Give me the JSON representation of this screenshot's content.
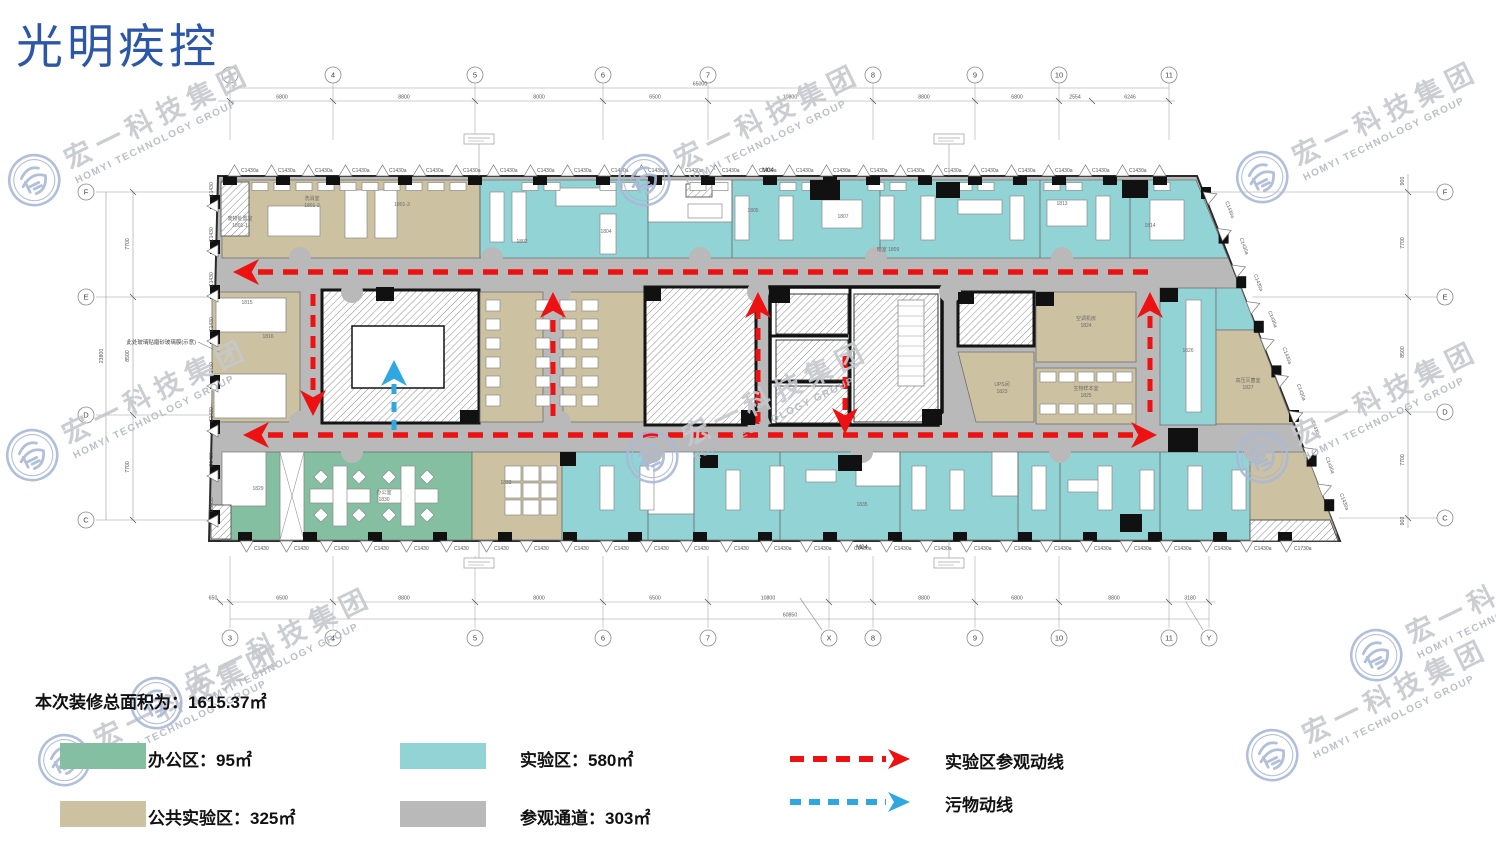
{
  "title": "光明疾控",
  "watermark": {
    "cn": "宏一科技集团",
    "en": "HOMYI TECHNOLOGY GROUP"
  },
  "summary": {
    "label": "本次装修总面积为：1615.37㎡"
  },
  "legend": {
    "areas": [
      {
        "name": "office",
        "label": "办公区：95㎡",
        "color": "#84bfa2"
      },
      {
        "name": "lab",
        "label": "实验区：580㎡",
        "color": "#92d3d6"
      },
      {
        "name": "public-lab",
        "label": "公共实验区：325㎡",
        "color": "#ccc1a0"
      },
      {
        "name": "corridor",
        "label": "参观通道：303㎡",
        "color": "#b9b9b9"
      }
    ],
    "routes": [
      {
        "name": "visit-route",
        "label": "实验区参观动线",
        "color": "#ee1111"
      },
      {
        "name": "waste-route",
        "label": "污物动线",
        "color": "#2fa8e1"
      }
    ]
  },
  "grid": {
    "top": {
      "cols": [
        {
          "label": "3",
          "x": 230
        },
        {
          "label": "4",
          "x": 333
        },
        {
          "label": "5",
          "x": 475
        },
        {
          "label": "6",
          "x": 603
        },
        {
          "label": "7",
          "x": 708
        },
        {
          "label": "8",
          "x": 873
        },
        {
          "label": "9",
          "x": 975
        },
        {
          "label": "10",
          "x": 1059
        },
        {
          "label": "11",
          "x": 1169
        }
      ],
      "dims": [
        {
          "label": "6800",
          "x": 282
        },
        {
          "label": "8800",
          "x": 404
        },
        {
          "label": "8000",
          "x": 539
        },
        {
          "label": "6500",
          "x": 655
        },
        {
          "label": "10800",
          "x": 790
        },
        {
          "label": "8800",
          "x": 924
        },
        {
          "label": "6800",
          "x": 1017
        },
        {
          "label": "2554",
          "x": 1075
        },
        {
          "label": "6246",
          "x": 1130
        }
      ],
      "extra_ticks": [
        1092
      ],
      "total": {
        "label": "65000",
        "x": 700
      }
    },
    "bottom": {
      "cols": [
        {
          "label": "3",
          "x": 230
        },
        {
          "label": "4",
          "x": 333
        },
        {
          "label": "5",
          "x": 475
        },
        {
          "label": "6",
          "x": 603
        },
        {
          "label": "7",
          "x": 708
        },
        {
          "label": "X",
          "x": 829
        },
        {
          "label": "8",
          "x": 873
        },
        {
          "label": "9",
          "x": 975
        },
        {
          "label": "10",
          "x": 1059
        },
        {
          "label": "11",
          "x": 1169
        },
        {
          "label": "Y",
          "x": 1209
        }
      ],
      "dims": [
        {
          "label": "650",
          "x": 213
        },
        {
          "label": "6500",
          "x": 282
        },
        {
          "label": "8800",
          "x": 404
        },
        {
          "label": "8000",
          "x": 539
        },
        {
          "label": "6500",
          "x": 655
        },
        {
          "label": "10800",
          "x": 768
        },
        {
          "label": "8800",
          "x": 924
        },
        {
          "label": "6800",
          "x": 1017
        },
        {
          "label": "8800",
          "x": 1114
        },
        {
          "label": "3180",
          "x": 1190
        }
      ],
      "extra_ticks": [
        220
      ],
      "total": {
        "label": "60850",
        "x": 790
      }
    },
    "left": {
      "rows": [
        {
          "label": "F",
          "y": 192
        },
        {
          "label": "E",
          "y": 297
        },
        {
          "label": "D",
          "y": 415
        },
        {
          "label": "C",
          "y": 520
        }
      ],
      "dims": [
        {
          "label": "7700",
          "y": 244
        },
        {
          "label": "8500",
          "y": 356
        },
        {
          "label": "7700",
          "y": 467
        }
      ],
      "total": {
        "label": "23800",
        "y": 356
      }
    },
    "right": {
      "rows": [
        {
          "label": "F",
          "y": 192
        },
        {
          "label": "E",
          "y": 297
        },
        {
          "label": "D",
          "y": 412
        },
        {
          "label": "C",
          "y": 518
        }
      ],
      "dims": [
        {
          "label": "900",
          "y": 181
        },
        {
          "label": "7700",
          "y": 243
        },
        {
          "label": "8500",
          "y": 352
        },
        {
          "label": "7700",
          "y": 460
        },
        {
          "label": "900",
          "y": 521
        }
      ]
    }
  },
  "plan": {
    "window_label": "C1430a",
    "window_label_alt": "C1430",
    "window_label_end": "C1730a",
    "door_labels": [
      {
        "label": "M04",
        "x": 768,
        "y": 172
      },
      {
        "label": "M04",
        "x": 862,
        "y": 549
      }
    ],
    "note": {
      "label": "此处玻璃贴磨砂玻璃膜(示意)",
      "x": 196,
      "y": 344
    },
    "room_labels": [
      {
        "label": "废物处置室",
        "x": 240,
        "y": 220
      },
      {
        "label": "1801-1",
        "x": 240,
        "y": 227
      },
      {
        "label": "洗消室",
        "x": 312,
        "y": 200
      },
      {
        "label": "1801-2",
        "x": 312,
        "y": 207
      },
      {
        "label": "1801-3",
        "x": 402,
        "y": 206
      },
      {
        "label": "1802",
        "x": 522,
        "y": 243
      },
      {
        "label": "1804",
        "x": 606,
        "y": 233
      },
      {
        "label": "1805",
        "x": 753,
        "y": 212
      },
      {
        "label": "1807",
        "x": 843,
        "y": 218
      },
      {
        "label": "暗室 1809",
        "x": 888,
        "y": 251
      },
      {
        "label": "1813",
        "x": 1062,
        "y": 205
      },
      {
        "label": "1814",
        "x": 1150,
        "y": 227
      },
      {
        "label": "1815",
        "x": 247,
        "y": 304
      },
      {
        "label": "1816",
        "x": 268,
        "y": 338
      },
      {
        "label": "UPS间",
        "x": 1002,
        "y": 386
      },
      {
        "label": "1823",
        "x": 1002,
        "y": 393
      },
      {
        "label": "空调机房",
        "x": 1086,
        "y": 320
      },
      {
        "label": "1824",
        "x": 1086,
        "y": 327
      },
      {
        "label": "生物样本室",
        "x": 1086,
        "y": 390
      },
      {
        "label": "1825",
        "x": 1086,
        "y": 397
      },
      {
        "label": "1826",
        "x": 1188,
        "y": 352
      },
      {
        "label": "高压灭菌室",
        "x": 1248,
        "y": 382
      },
      {
        "label": "1827",
        "x": 1248,
        "y": 389
      },
      {
        "label": "1829",
        "x": 258,
        "y": 490
      },
      {
        "label": "办公室",
        "x": 384,
        "y": 494
      },
      {
        "label": "1830",
        "x": 384,
        "y": 501
      },
      {
        "label": "1832",
        "x": 506,
        "y": 484
      },
      {
        "label": "1835",
        "x": 862,
        "y": 506
      }
    ]
  }
}
